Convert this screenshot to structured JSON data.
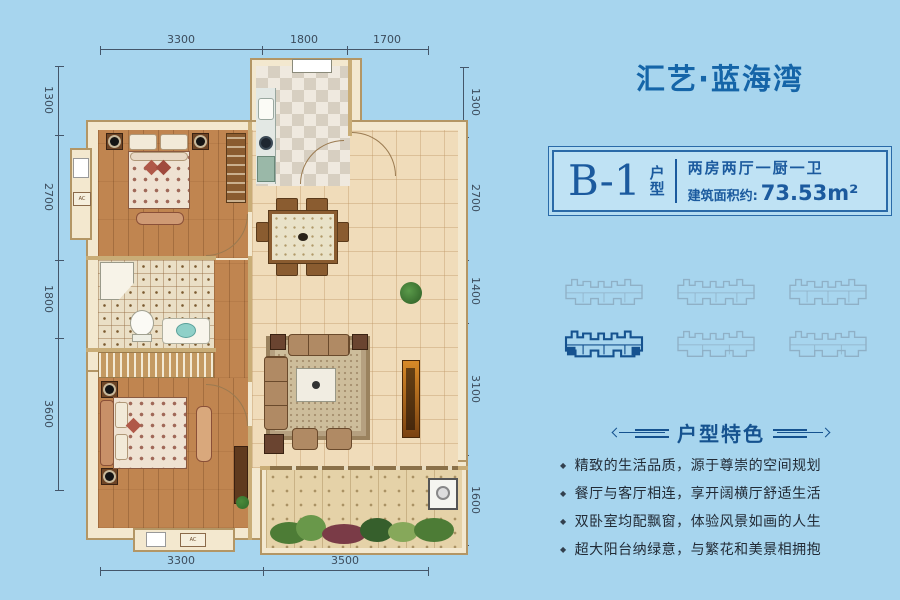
{
  "project": {
    "title": "汇艺·蓝海湾"
  },
  "unit": {
    "code": "B-1",
    "type_label": "户型",
    "layout": "两房两厅一厨一卫",
    "area_label": "建筑面积约:",
    "area_value": "73.53m²"
  },
  "site_plan": {
    "total_buildings": 6,
    "selected_building": 4
  },
  "features": {
    "heading": "户型特色",
    "items": [
      "精致的生活品质，源于尊崇的空间规划",
      "餐厅与客厅相连，享开阔横厅舒适生活",
      "双卧室均配飘窗，体验风景如画的人生",
      "超大阳台纳绿意，与繁花和美景相拥抱"
    ]
  },
  "floor_plan": {
    "ac_label": "AC",
    "dimensions_top": [
      "3300",
      "1800",
      "1700"
    ],
    "dimensions_bottom": [
      "3300",
      "3500"
    ],
    "dimensions_left": [
      "1300",
      "2700",
      "1800",
      "3600"
    ],
    "dimensions_right": [
      "1300",
      "2700",
      "1400",
      "3100",
      "1600"
    ]
  },
  "colors": {
    "background": "#a7d5ee",
    "brand_blue": "#15609f",
    "wall_cream": "#f3e8cf",
    "wood_floor": "#c08550",
    "tile_floor": "#f0dcba",
    "feature_text": "#222b36"
  }
}
